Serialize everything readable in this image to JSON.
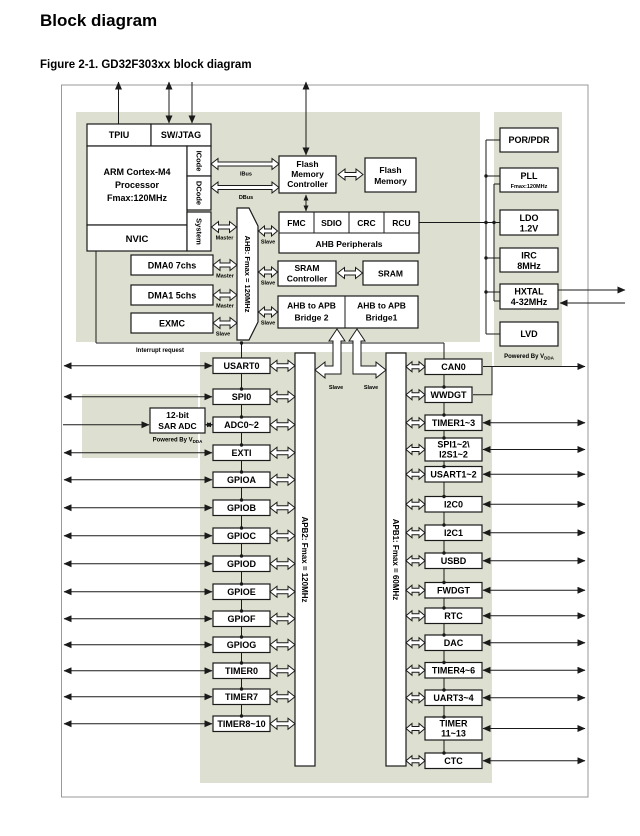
{
  "page": {
    "title": "Block diagram",
    "caption": "Figure 2-1. GD32F303xx block diagram"
  },
  "colors": {
    "shade": "#dde0d0",
    "line": "#1a1a1a",
    "frame": "#9a9a9a",
    "box_fill": "#ffffff"
  },
  "cpu": {
    "tpiu": "TPIU",
    "swjtag": "SW/JTAG",
    "core1": "ARM Cortex-M4",
    "core2": "Processor",
    "core3": "Fmax:120MHz",
    "nvic": "NVIC",
    "icode": "ICode",
    "dcode": "DCode",
    "system": "System"
  },
  "labels": {
    "ibus": "IBus",
    "dbus": "DBus",
    "master": "Master",
    "slave": "Slave",
    "interrupt": "Interrupt request"
  },
  "buses": {
    "ahb": "AHB: Fmax = 120MHz",
    "apb2": "APB2: Fmax = 120MHz",
    "apb1": "APB1: Fmax = 60MHz"
  },
  "flash": {
    "c1": "Flash",
    "c2": "Memory",
    "c3": "Controller",
    "m1": "Flash",
    "m2": "Memory"
  },
  "ahbp": {
    "cells": [
      "FMC",
      "SDIO",
      "CRC",
      "RCU"
    ],
    "label": "AHB Peripherals"
  },
  "sram": {
    "c1": "SRAM",
    "c2": "Controller",
    "mem": "SRAM"
  },
  "bridges": {
    "b2a": "AHB to APB",
    "b2b": "Bridge 2",
    "b1a": "AHB to APB",
    "b1b": "Bridge1"
  },
  "dma": {
    "d0": "DMA0 7chs",
    "d1": "DMA1 5chs",
    "exmc": "EXMC"
  },
  "adc": {
    "l1": "12-bit",
    "l2": "SAR ADC",
    "powered": "Powered By V",
    "powered_sub": "DDA"
  },
  "clocks": {
    "porpdr": "POR/PDR",
    "pll": "PLL",
    "pll_sub": "Fmax:120MHz",
    "ldo1": "LDO",
    "ldo2": "1.2V",
    "irc1": "IRC",
    "irc2": "8MHz",
    "hxtal1": "HXTAL",
    "hxtal2": "4-32MHz",
    "lvd": "LVD",
    "powered": "Powered By V",
    "powered_sub": "DDA"
  },
  "apb2_peripherals": [
    "USART0",
    "SPI0",
    "ADC0~2",
    "EXTI",
    "GPIOA",
    "GPIOB",
    "GPIOC",
    "GPIOD",
    "GPIOE",
    "GPIOF",
    "GPIOG",
    "TIMER0",
    "TIMER7",
    "TIMER8~10"
  ],
  "apb1_peripherals": [
    {
      "l1": "CAN0"
    },
    {
      "l1": "WWDGT"
    },
    {
      "l1": "TIMER1~3"
    },
    {
      "l1": "SPI1~2\\",
      "l2": "I2S1~2"
    },
    {
      "l1": "USART1~2"
    },
    {
      "l1": "I2C0"
    },
    {
      "l1": "I2C1"
    },
    {
      "l1": "USBD"
    },
    {
      "l1": "FWDGT"
    },
    {
      "l1": "RTC"
    },
    {
      "l1": "DAC"
    },
    {
      "l1": "TIMER4~6"
    },
    {
      "l1": "UART3~4"
    },
    {
      "l1": "TIMER",
      "l2": "11~13"
    },
    {
      "l1": "CTC"
    }
  ]
}
